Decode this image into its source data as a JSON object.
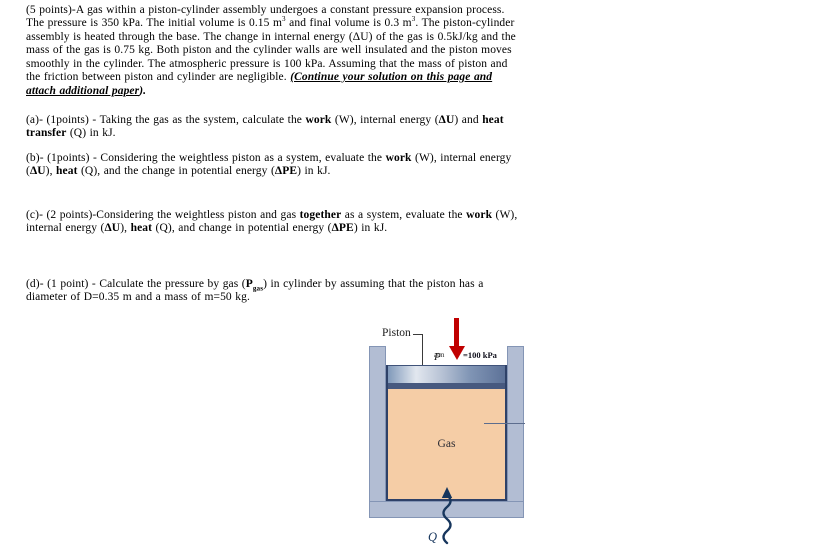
{
  "document": {
    "paragraphs": {
      "problem": [
        {
          "t": "(5 points)-A gas within a piston-cylinder assembly undergoes a constant pressure expansion process. The pressure is 350 kPa. The initial volume is 0.15 m"
        },
        {
          "t": "3",
          "s": "sup"
        },
        {
          "t": " and final volume is 0.3 m"
        },
        {
          "t": "3",
          "s": "sup"
        },
        {
          "t": ". The piston-cylinder assembly is heated through the base. The change in internal energy (ΔU) of the gas is 0.5kJ/kg and the mass of the gas is 0.75 kg. Both piston and the cylinder walls are well insulated and the piston moves smoothly in the cylinder. The atmospheric pressure is 100 kPa. Assuming that the mass of piston and the friction between piston and cylinder are negligible. "
        },
        {
          "t": "(Continue your solution on this page and attach additional paper",
          "s": "b i u"
        },
        {
          "t": ").",
          "s": "b i"
        }
      ],
      "part_a": [
        {
          "t": "(a)- (1points) - Taking the gas as the system, calculate the "
        },
        {
          "t": "work",
          "s": "b"
        },
        {
          "t": " (W), internal energy ("
        },
        {
          "t": "ΔU",
          "s": "b"
        },
        {
          "t": ") and "
        },
        {
          "t": "heat transfer",
          "s": "b"
        },
        {
          "t": " (Q) in kJ."
        }
      ],
      "part_b": [
        {
          "t": "(b)- (1points) - Considering the weightless piston as a system, evaluate the "
        },
        {
          "t": "work",
          "s": "b"
        },
        {
          "t": " (W), internal energy ("
        },
        {
          "t": "ΔU",
          "s": "b"
        },
        {
          "t": "), "
        },
        {
          "t": "heat",
          "s": "b"
        },
        {
          "t": " (Q), and the change in potential energy ("
        },
        {
          "t": "ΔPE",
          "s": "b"
        },
        {
          "t": ") in kJ."
        }
      ],
      "part_c": [
        {
          "t": "(c)- (2 points)-Considering the weightless piston and gas "
        },
        {
          "t": "together",
          "s": "b"
        },
        {
          "t": " as a system, evaluate the "
        },
        {
          "t": "work",
          "s": "b"
        },
        {
          "t": " (W), internal energy ("
        },
        {
          "t": "ΔU",
          "s": "b"
        },
        {
          "t": "), "
        },
        {
          "t": "heat",
          "s": "b"
        },
        {
          "t": " (Q), and change in potential energy ("
        },
        {
          "t": "ΔPE",
          "s": "b"
        },
        {
          "t": ") in kJ."
        }
      ],
      "part_d": [
        {
          "t": "(d)- (1 point) - Calculate the pressure by gas ("
        },
        {
          "t": "P",
          "s": "b"
        },
        {
          "t": "gas",
          "s": "b sub"
        },
        {
          "t": ") in cylinder by assuming that the piston has a diameter of D=0.35 m and a mass of m=50 kg."
        }
      ]
    }
  },
  "figure": {
    "piston_label": "Piston",
    "patm": {
      "symbol": "P",
      "subscript": "atm",
      "value": "=100 kPa"
    },
    "gas_label": "Gas",
    "heat_label": "Q",
    "colors": {
      "wall": "#b2bdd3",
      "wall_border": "#8495b5",
      "cavity_border": "#2e4168",
      "gas": "#f5cda6",
      "piston_band": "#47597f",
      "piston_grad_left": "#8099ba",
      "piston_grad_light": "#e2e7ef",
      "piston_grad_right": "#5d7298",
      "pressure_arrow": "#c00000",
      "heat_arrow": "#17365d"
    }
  }
}
